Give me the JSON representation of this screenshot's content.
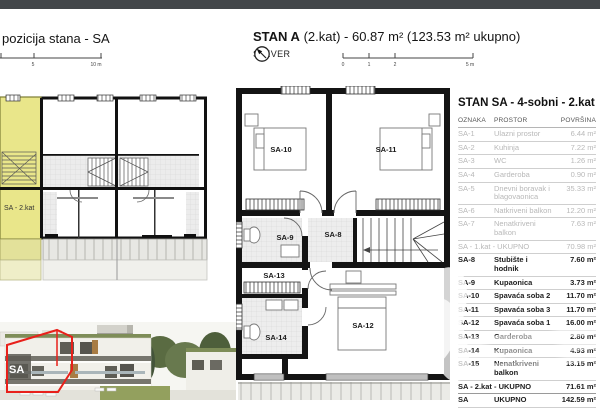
{
  "page": {
    "topbar_color": "#43474a",
    "background": "#ffffff"
  },
  "left": {
    "title": "pozicija stana - SA",
    "scale": {
      "mid": "5",
      "end": "10 m"
    },
    "siteplan": {
      "unit_label": "SA - 2.kat",
      "highlight_color": "#e9e68a"
    },
    "photo": {
      "unit_label": "SA",
      "outline_color": "#e8201a"
    }
  },
  "center": {
    "title_bold": "STAN A",
    "title_rest": "(2.kat) - 60.87 m² (123.53 m² ukupno)",
    "north_label": "SJEVER",
    "scale_ticks": [
      "0",
      "1",
      "2",
      "5 m"
    ]
  },
  "floorplan": {
    "rooms": {
      "sa8": "SA-8",
      "sa9": "SA-9",
      "sa10": "SA-10",
      "sa11": "SA-11",
      "sa12": "SA-12",
      "sa13": "SA-13",
      "sa14": "SA-14"
    }
  },
  "table": {
    "title": "STAN SA - 4-sobni - 2.kat",
    "columns": [
      "OZNAKA",
      "PROSTOR",
      "POVRŠINA"
    ],
    "area_suffix": "m²",
    "rows": [
      {
        "id": "SA-1",
        "name": "Ulazni prostor",
        "area": "6.44",
        "muted": true
      },
      {
        "id": "SA-2",
        "name": "Kuhinja",
        "area": "7.22",
        "muted": true
      },
      {
        "id": "SA-3",
        "name": "WC",
        "area": "1.26",
        "muted": true
      },
      {
        "id": "SA-4",
        "name": "Garderoba",
        "area": "0.90",
        "muted": true
      },
      {
        "id": "SA-5",
        "name": "Dnevni boravak i blagovaonica",
        "area": "35.33",
        "muted": true
      },
      {
        "id": "SA-6",
        "name": "Natkriveni balkon",
        "area": "12.20",
        "muted": true
      },
      {
        "id": "SA-7",
        "name": "Nenatkriveni balkon",
        "area": "7.63",
        "muted": true
      },
      {
        "id": "SA - 1.kat - UKUPNO",
        "name": "",
        "area": "70.98",
        "muted": true,
        "summary": true
      },
      {
        "id": "SA-8",
        "name": "Stubište i hodnik",
        "area": "7.60"
      },
      {
        "id": "SA-9",
        "name": "Kupaonica",
        "area": "3.73"
      },
      {
        "id": "SA-10",
        "name": "Spavaća soba 2",
        "area": "11.70"
      },
      {
        "id": "SA-11",
        "name": "Spavaća soba 3",
        "area": "11.70"
      },
      {
        "id": "SA-12",
        "name": "Spavaća soba 1",
        "area": "16.00"
      },
      {
        "id": "SA-13",
        "name": "Garderoba",
        "area": "2.80"
      },
      {
        "id": "SA-14",
        "name": "Kupaonica",
        "area": "4.93"
      },
      {
        "id": "SA-15",
        "name": "Nenatkriveni balkon",
        "area": "13.15"
      },
      {
        "id": "SA - 2.kat - UKUPNO",
        "name": "",
        "area": "71.61",
        "summary": true
      },
      {
        "id": "SA",
        "name": "UKUPNO",
        "area": "142.59",
        "total": true
      }
    ]
  }
}
